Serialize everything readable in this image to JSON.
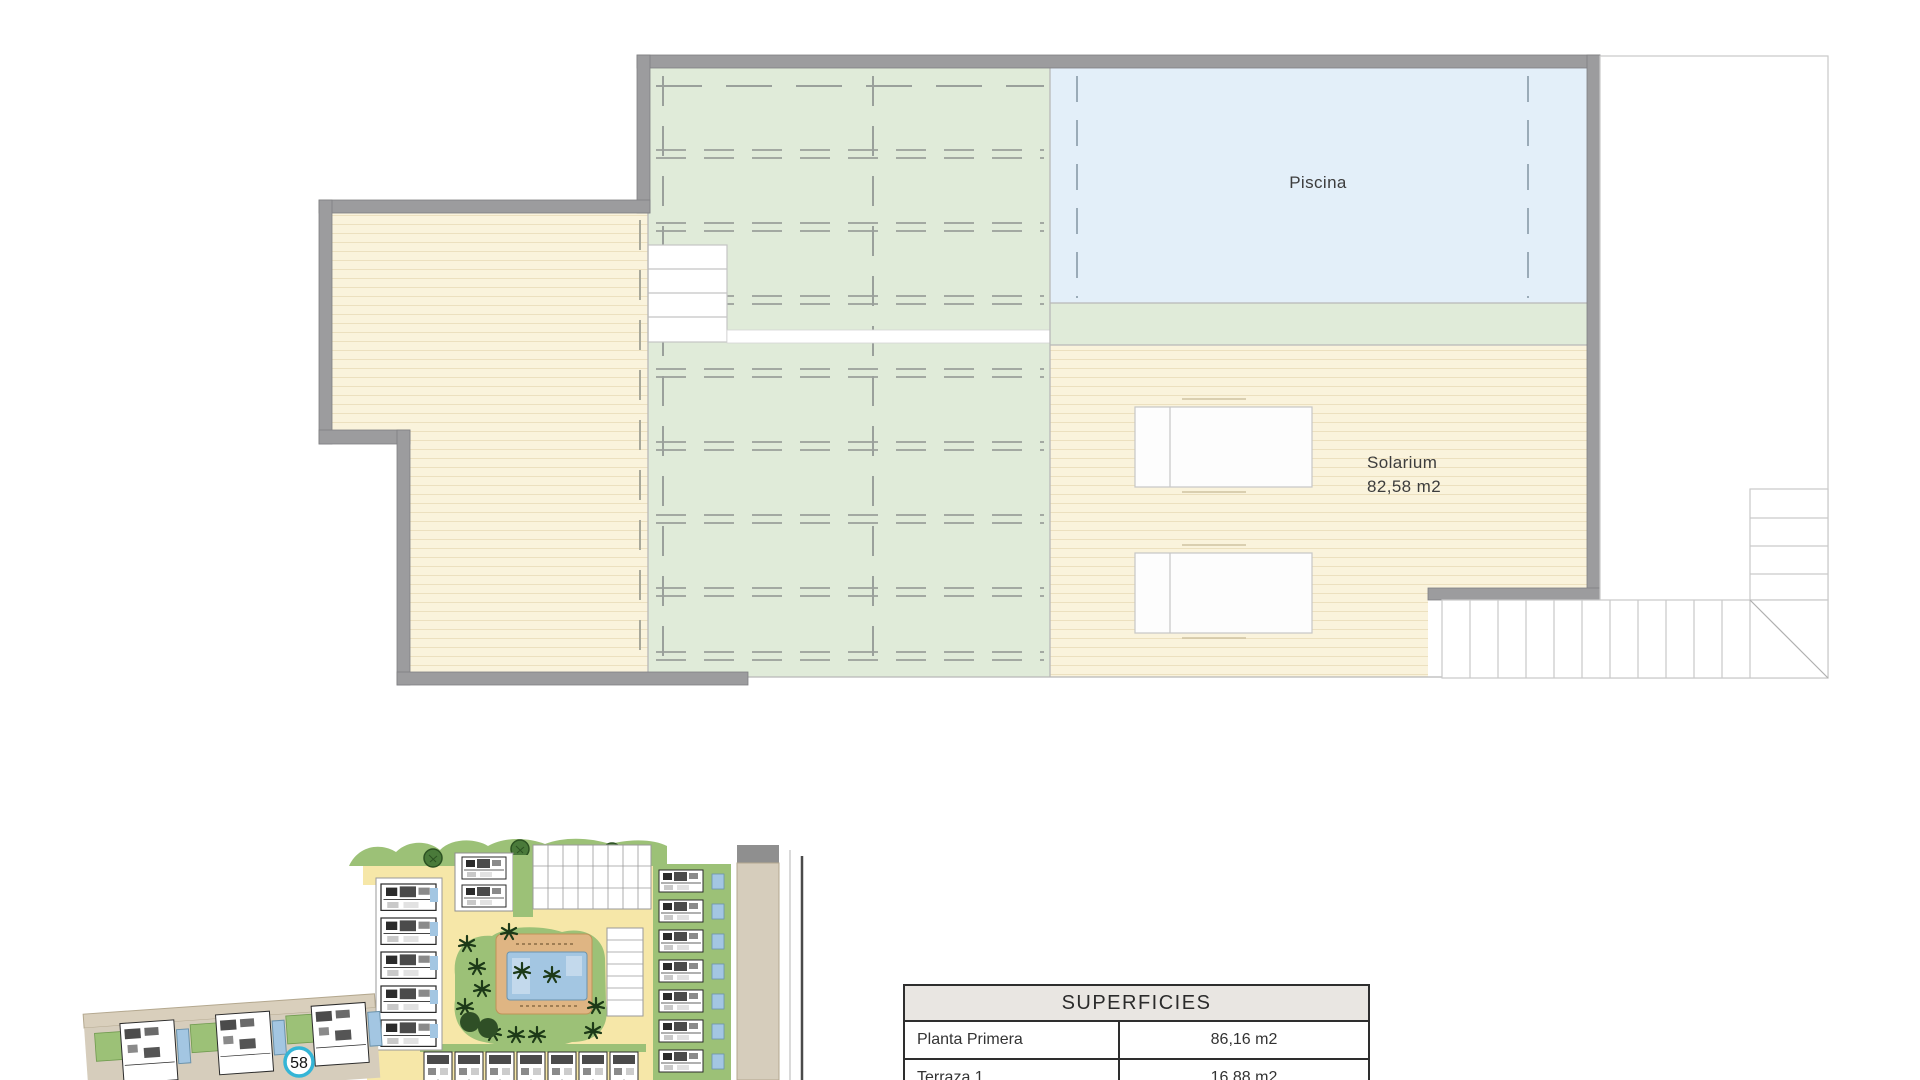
{
  "floor_plan": {
    "pool_label": "Piscina",
    "solarium_label": "Solarium",
    "solarium_area": "82,58 m2",
    "colors": {
      "wall_gray": "#9c9c9e",
      "deck_cream": "#faf3dc",
      "pergola_green": "#e0ebd9",
      "pool_blue": "#e3eff9",
      "thin_line": "#b8b8b8",
      "dash_line": "#9aa09b"
    }
  },
  "site_plan": {
    "unit_badge": "58",
    "colors": {
      "road_yellow": "#f6e7a8",
      "grass_green": "#9cc177",
      "tree_green": "#2f4f26",
      "pool_blue": "#a3c6e2",
      "deck_orange": "#dfb583",
      "land_tan": "#d6cdbc",
      "badge_ring": "#35b5d6"
    }
  },
  "summary_table": {
    "title": "SUPERFICIES",
    "rows": [
      {
        "label": "Planta Primera",
        "value": "86,16 m2"
      },
      {
        "label": "Terraza 1",
        "value": "16,88 m2"
      }
    ]
  }
}
